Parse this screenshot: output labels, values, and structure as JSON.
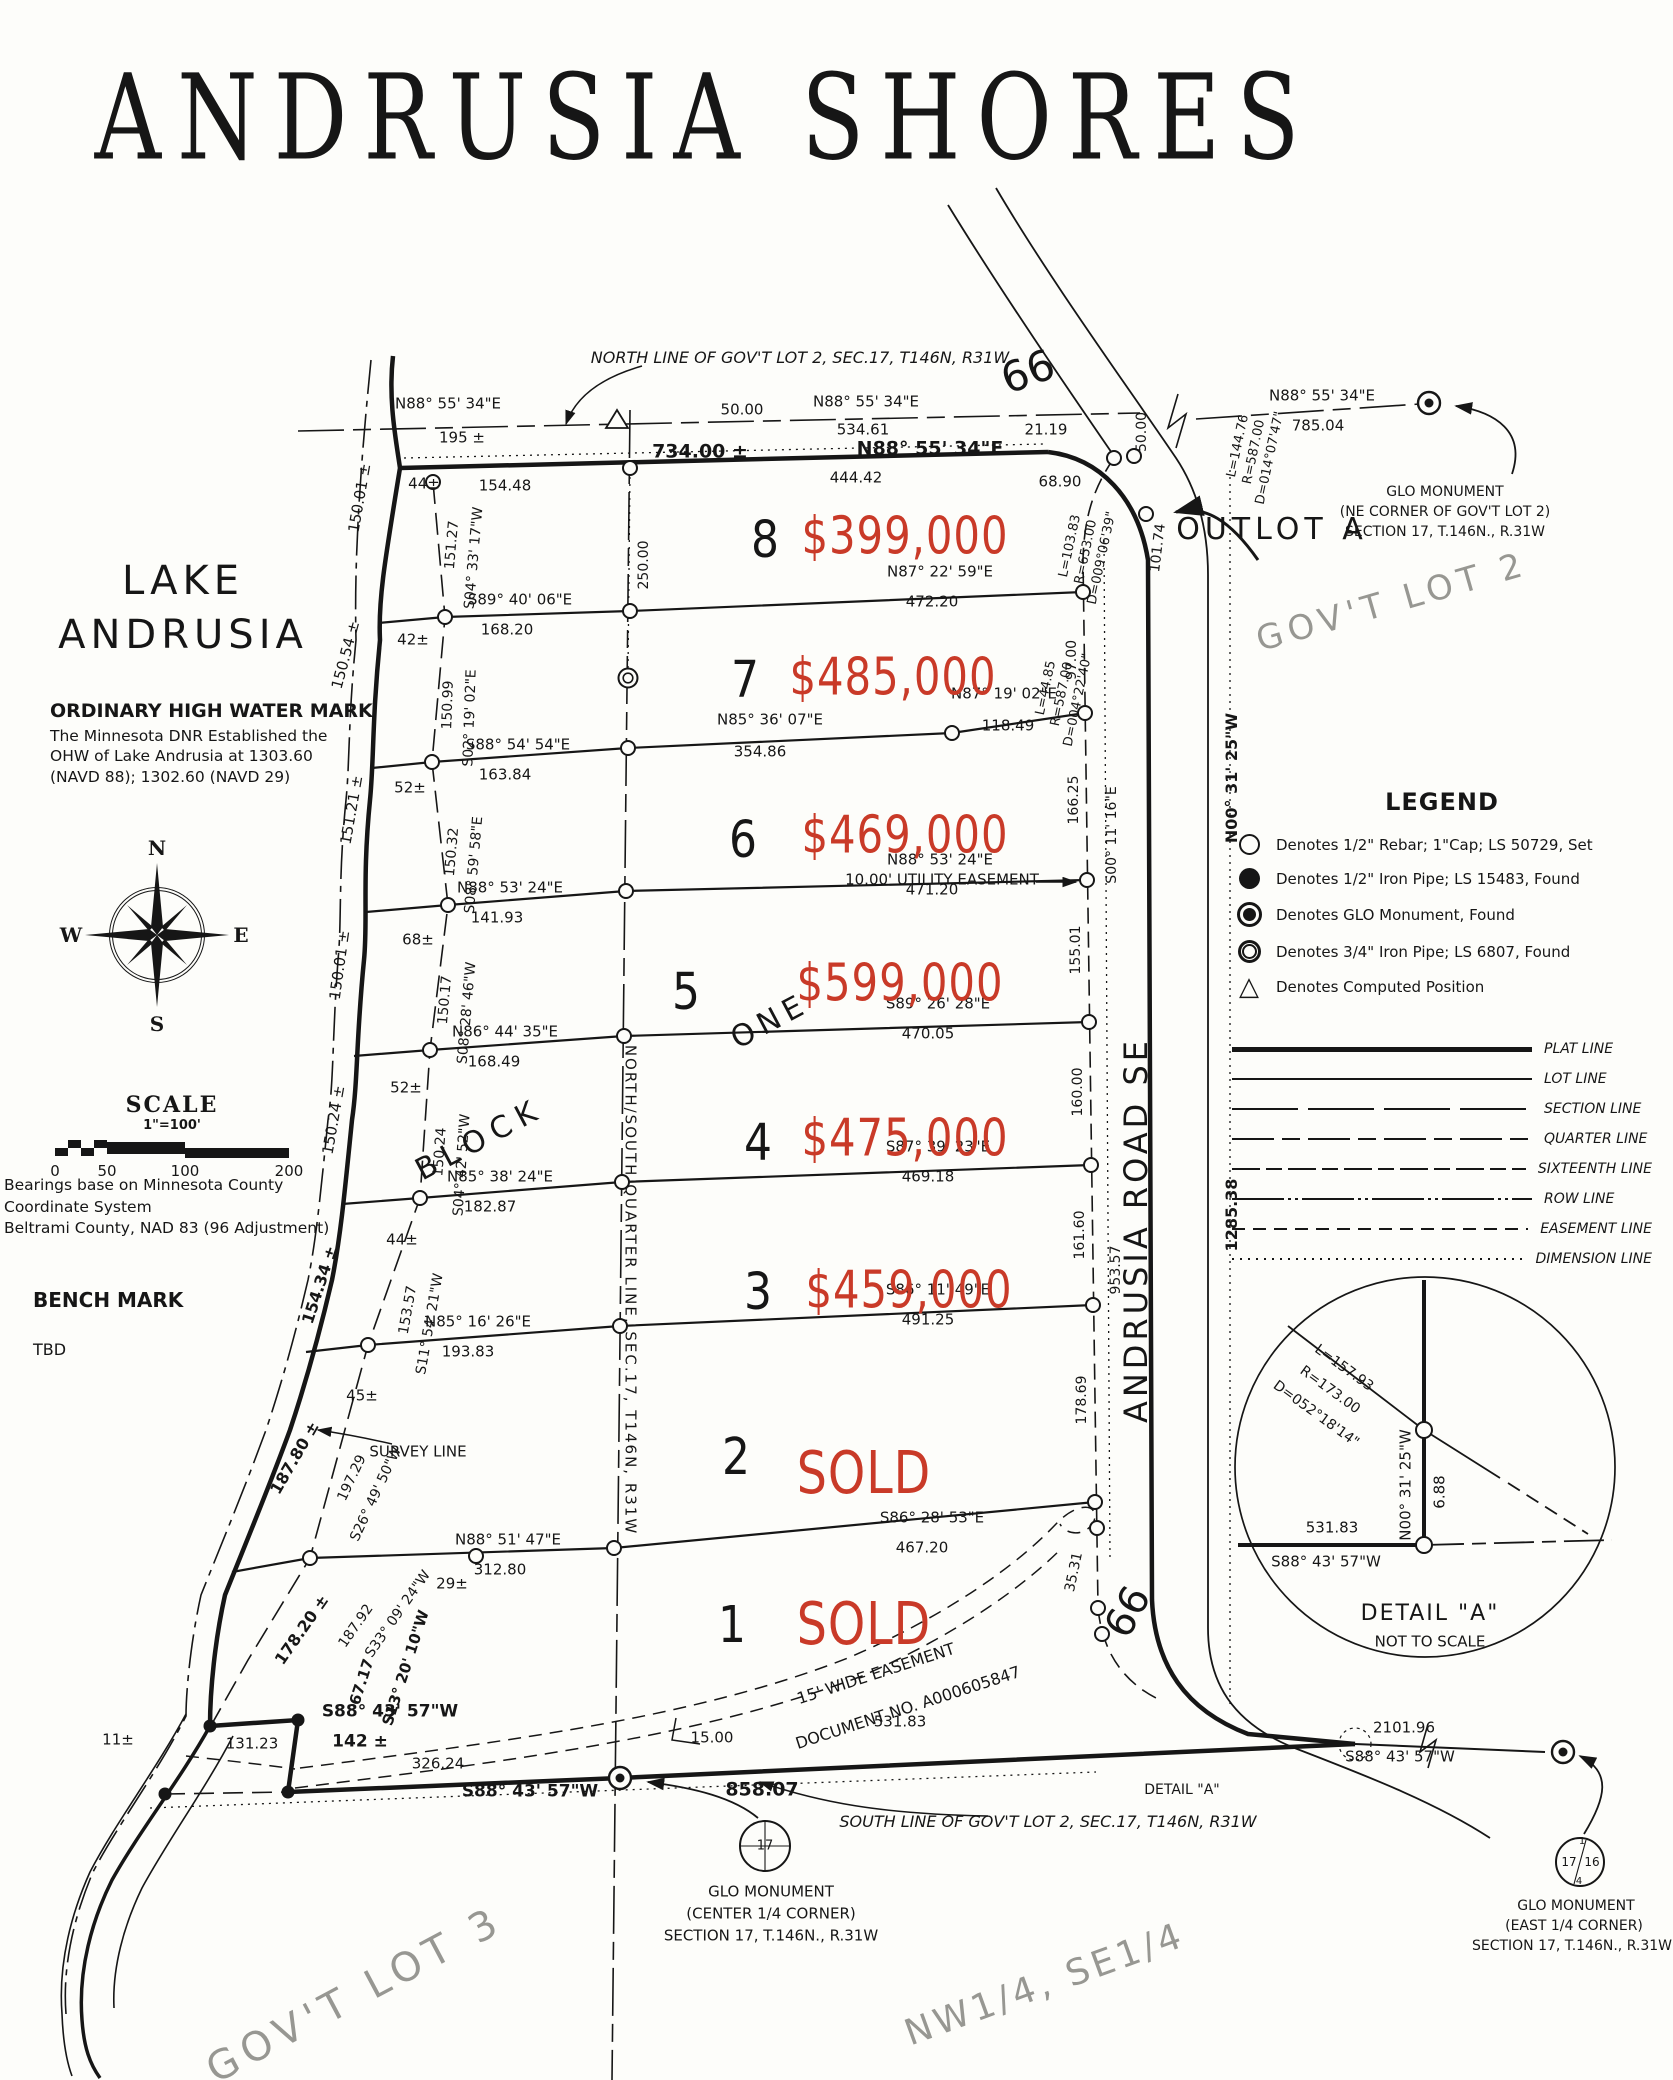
{
  "title": "ANDRUSIA SHORES",
  "colors": {
    "ink": "#161616",
    "red": "#c93a28",
    "ghost": "#979792"
  },
  "lake": {
    "line1": "LAKE",
    "line2": "ANDRUSIA"
  },
  "ohw": {
    "heading": "ORDINARY HIGH WATER MARK",
    "lines": [
      "The Minnesota DNR Established the",
      "OHW of Lake Andrusia at 1303.60",
      "(NAVD 88); 1302.60 (NAVD 29)"
    ]
  },
  "compass": {
    "n": "N",
    "e": "E",
    "s": "S",
    "w": "W"
  },
  "scale": {
    "heading": "SCALE",
    "ratio": "1\"=100'",
    "ticks": [
      "0",
      "50",
      "100",
      "200"
    ]
  },
  "bearings_note": [
    "Bearings base on Minnesota County Coordinate System",
    "Beltrami County, NAD 83 (96 Adjustment)"
  ],
  "benchmark": {
    "heading": "BENCH MARK",
    "value": "TBD"
  },
  "legend": {
    "heading": "LEGEND",
    "symbols": [
      {
        "icon": "rebar",
        "text": "Denotes 1/2\" Rebar; 1\"Cap; LS 50729, Set"
      },
      {
        "icon": "pipe",
        "text": "Denotes 1/2\" Iron Pipe; LS 15483, Found"
      },
      {
        "icon": "glo",
        "text": "Denotes GLO Monument, Found"
      },
      {
        "icon": "pipe34",
        "text": "Denotes 3/4\" Iron Pipe; LS 6807, Found"
      },
      {
        "icon": "tri",
        "text": "Denotes Computed Position"
      }
    ],
    "lines": [
      {
        "style": "plat",
        "label": "PLAT LINE"
      },
      {
        "style": "lot",
        "label": "LOT LINE"
      },
      {
        "style": "section",
        "label": "SECTION LINE"
      },
      {
        "style": "quarter",
        "label": "QUARTER LINE"
      },
      {
        "style": "sixteenth",
        "label": "SIXTEENTH LINE"
      },
      {
        "style": "row",
        "label": "ROW LINE"
      },
      {
        "style": "easement",
        "label": "EASEMENT LINE"
      },
      {
        "style": "dimension",
        "label": "DIMENSION LINE"
      }
    ]
  },
  "lots": [
    {
      "number": "8",
      "price": "$399,000",
      "nx": 765,
      "ny": 541,
      "px": 905,
      "py": 537
    },
    {
      "number": "7",
      "price": "$485,000",
      "nx": 745,
      "ny": 681,
      "px": 893,
      "py": 678
    },
    {
      "number": "6",
      "price": "$469,000",
      "nx": 743,
      "ny": 841,
      "px": 905,
      "py": 836
    },
    {
      "number": "5",
      "price": "$599,000",
      "nx": 686,
      "ny": 993,
      "px": 900,
      "py": 984
    },
    {
      "number": "4",
      "price": "$475,000",
      "nx": 758,
      "ny": 1144,
      "px": 905,
      "py": 1139
    },
    {
      "number": "3",
      "price": "$459,000",
      "nx": 758,
      "ny": 1293,
      "px": 909,
      "py": 1291
    },
    {
      "number": "2",
      "price": "SOLD",
      "nx": 736,
      "ny": 1458,
      "px": 864,
      "py": 1473
    },
    {
      "number": "1",
      "price": "SOLD",
      "nx": 732,
      "ny": 1626,
      "px": 864,
      "py": 1624
    }
  ],
  "map_labels": [
    {
      "t": "NORTH LINE OF GOV'T LOT 2, SEC.17, T146N, R31W",
      "x": 800,
      "y": 358,
      "s": 16,
      "i": 1
    },
    {
      "t": "66",
      "x": 1028,
      "y": 372,
      "r": -20,
      "s": 42
    },
    {
      "t": "66",
      "x": 1128,
      "y": 1612,
      "r": -62,
      "s": 40
    },
    {
      "t": "N88° 55' 34\"E",
      "x": 448,
      "y": 404
    },
    {
      "t": "195 ±",
      "x": 462,
      "y": 438
    },
    {
      "t": "50.00",
      "x": 742,
      "y": 410
    },
    {
      "t": "N88° 55' 34\"E",
      "x": 866,
      "y": 402
    },
    {
      "t": "534.61",
      "x": 863,
      "y": 430
    },
    {
      "t": "21.19",
      "x": 1046,
      "y": 430
    },
    {
      "t": "N88° 55' 34\"E",
      "x": 1322,
      "y": 396
    },
    {
      "t": "785.04",
      "x": 1318,
      "y": 426
    },
    {
      "t": "734.00 ±",
      "x": 700,
      "y": 452,
      "s": 19,
      "b": 1
    },
    {
      "t": "N88° 55' 34\"E",
      "x": 930,
      "y": 449,
      "s": 19,
      "b": 1
    },
    {
      "t": "154.48",
      "x": 505,
      "y": 486
    },
    {
      "t": "444.42",
      "x": 856,
      "y": 478
    },
    {
      "t": "68.90",
      "x": 1060,
      "y": 482
    },
    {
      "t": "44±",
      "x": 424,
      "y": 484
    },
    {
      "t": "50.00",
      "x": 1142,
      "y": 432,
      "r": -90,
      "s": 14
    },
    {
      "t": "101.74",
      "x": 1158,
      "y": 548,
      "r": -83,
      "s": 14
    },
    {
      "t": "L=103.83",
      "x": 1070,
      "y": 546,
      "r": -78,
      "s": 13
    },
    {
      "t": "R=653.00",
      "x": 1086,
      "y": 552,
      "r": -78,
      "s": 13
    },
    {
      "t": "D=009°06'39\"",
      "x": 1102,
      "y": 558,
      "r": -78,
      "s": 13
    },
    {
      "t": "GLO MONUMENT",
      "x": 1445,
      "y": 492,
      "s": 14
    },
    {
      "t": "(NE CORNER OF GOV'T LOT 2)",
      "x": 1445,
      "y": 512,
      "s": 14
    },
    {
      "t": "SECTION 17, T.146N., R.31W",
      "x": 1445,
      "y": 532,
      "s": 14
    },
    {
      "t": "OUTLOT A",
      "x": 1272,
      "y": 530,
      "s": 30,
      "ls": 5
    },
    {
      "t": "GOV'T LOT 2",
      "x": 1392,
      "y": 602,
      "r": -16,
      "s": 34,
      "g": 1,
      "ls": 6
    },
    {
      "t": "L=144.76",
      "x": 1238,
      "y": 446,
      "r": -78,
      "s": 13
    },
    {
      "t": "R=587.00",
      "x": 1254,
      "y": 452,
      "r": -78,
      "s": 13
    },
    {
      "t": "D=014°07'47\"",
      "x": 1270,
      "y": 458,
      "r": -78,
      "s": 13
    },
    {
      "t": "150.01 ±",
      "x": 360,
      "y": 498,
      "r": -80,
      "s": 15
    },
    {
      "t": "151.27",
      "x": 452,
      "y": 545,
      "r": -85,
      "s": 14
    },
    {
      "t": "S04° 33' 17\"W",
      "x": 474,
      "y": 558,
      "r": -85,
      "s": 14
    },
    {
      "t": "S89° 40' 06\"E",
      "x": 520,
      "y": 600
    },
    {
      "t": "168.20",
      "x": 507,
      "y": 630
    },
    {
      "t": "N87° 22' 59\"E",
      "x": 940,
      "y": 572
    },
    {
      "t": "472.20",
      "x": 932,
      "y": 602
    },
    {
      "t": "42±",
      "x": 413,
      "y": 640
    },
    {
      "t": "250.00",
      "x": 644,
      "y": 565,
      "r": -90,
      "s": 14
    },
    {
      "t": "150.54 ±",
      "x": 346,
      "y": 655,
      "r": -75,
      "s": 15
    },
    {
      "t": "150.99",
      "x": 448,
      "y": 705,
      "r": -88,
      "s": 14
    },
    {
      "t": "S02° 19' 02\"E",
      "x": 470,
      "y": 718,
      "r": -88,
      "s": 14
    },
    {
      "t": "L=44.85",
      "x": 1046,
      "y": 688,
      "r": -78,
      "s": 13
    },
    {
      "t": "R=587.00",
      "x": 1062,
      "y": 694,
      "r": -78,
      "s": 13
    },
    {
      "t": "D=004°22'40\"",
      "x": 1078,
      "y": 700,
      "r": -78,
      "s": 13
    },
    {
      "t": "97.00",
      "x": 1072,
      "y": 660,
      "r": -90,
      "s": 14
    },
    {
      "t": "S88° 54' 54\"E",
      "x": 518,
      "y": 745
    },
    {
      "t": "163.84",
      "x": 505,
      "y": 775
    },
    {
      "t": "N85° 36' 07\"E",
      "x": 770,
      "y": 720
    },
    {
      "t": "354.86",
      "x": 760,
      "y": 752
    },
    {
      "t": "N87° 19' 02\"E",
      "x": 1004,
      "y": 694
    },
    {
      "t": "118.49",
      "x": 1008,
      "y": 726
    },
    {
      "t": "52±",
      "x": 410,
      "y": 788
    },
    {
      "t": "151.21 ±",
      "x": 352,
      "y": 810,
      "r": -80,
      "s": 15
    },
    {
      "t": "150.32",
      "x": 452,
      "y": 852,
      "r": -85,
      "s": 14
    },
    {
      "t": "S08° 59' 58\"E",
      "x": 474,
      "y": 865,
      "r": -85,
      "s": 14
    },
    {
      "t": "10.00' UTILITY EASEMENT",
      "x": 942,
      "y": 880,
      "s": 15
    },
    {
      "t": "166.25",
      "x": 1074,
      "y": 800,
      "r": -90,
      "s": 14
    },
    {
      "t": "N88° 53' 24\"E",
      "x": 510,
      "y": 888
    },
    {
      "t": "141.93",
      "x": 497,
      "y": 918
    },
    {
      "t": "N88° 53' 24\"E",
      "x": 940,
      "y": 860
    },
    {
      "t": "471.20",
      "x": 932,
      "y": 890
    },
    {
      "t": "68±",
      "x": 418,
      "y": 940
    },
    {
      "t": "150.01 ±",
      "x": 340,
      "y": 965,
      "r": -82,
      "s": 15
    },
    {
      "t": "150.17",
      "x": 445,
      "y": 1000,
      "r": -85,
      "s": 14
    },
    {
      "t": "S08° 28' 46\"W",
      "x": 467,
      "y": 1013,
      "r": -85,
      "s": 14
    },
    {
      "t": "155.01",
      "x": 1076,
      "y": 950,
      "r": -90,
      "s": 14
    },
    {
      "t": "S00° 11' 16\"E",
      "x": 1112,
      "y": 835,
      "r": -90,
      "s": 14
    },
    {
      "t": "ONE",
      "x": 770,
      "y": 1022,
      "r": -28,
      "s": 30,
      "ls": 6
    },
    {
      "t": "N86° 44' 35\"E",
      "x": 505,
      "y": 1032
    },
    {
      "t": "168.49",
      "x": 494,
      "y": 1062
    },
    {
      "t": "S89° 26' 28\"E",
      "x": 938,
      "y": 1004
    },
    {
      "t": "470.05",
      "x": 928,
      "y": 1034
    },
    {
      "t": "52±",
      "x": 406,
      "y": 1088
    },
    {
      "t": "150.24 ±",
      "x": 334,
      "y": 1120,
      "r": -80,
      "s": 15
    },
    {
      "t": "150.24",
      "x": 440,
      "y": 1152,
      "r": -86,
      "s": 14
    },
    {
      "t": "S04° 42' 52\"W",
      "x": 462,
      "y": 1165,
      "r": -86,
      "s": 14
    },
    {
      "t": "BLOCK",
      "x": 480,
      "y": 1140,
      "r": -28,
      "s": 30,
      "ls": 8
    },
    {
      "t": "160.00",
      "x": 1078,
      "y": 1092,
      "r": -90,
      "s": 14
    },
    {
      "t": "NORTH/SOUTH QUARTER LINE,  SEC.17, T146N, R31W",
      "x": 630,
      "y": 1290,
      "r": 90,
      "s": 15,
      "ls": 2
    },
    {
      "t": "N85° 38' 24\"E",
      "x": 500,
      "y": 1177
    },
    {
      "t": "182.87",
      "x": 490,
      "y": 1207
    },
    {
      "t": "S87° 39' 23\"E",
      "x": 938,
      "y": 1147
    },
    {
      "t": "469.18",
      "x": 928,
      "y": 1177
    },
    {
      "t": "44±",
      "x": 402,
      "y": 1240
    },
    {
      "t": "154.34 ±",
      "x": 320,
      "y": 1285,
      "r": -72,
      "s": 16,
      "b": 1
    },
    {
      "t": "153.57",
      "x": 408,
      "y": 1310,
      "r": -80,
      "s": 14
    },
    {
      "t": "S11° 54' 21\"W",
      "x": 430,
      "y": 1324,
      "r": -80,
      "s": 14
    },
    {
      "t": "161.60",
      "x": 1080,
      "y": 1235,
      "r": -90,
      "s": 14
    },
    {
      "t": "953.57",
      "x": 1116,
      "y": 1270,
      "r": -90,
      "s": 14
    },
    {
      "t": "ANDRUSIA ROAD SE",
      "x": 1136,
      "y": 1230,
      "r": -90,
      "s": 32,
      "ls": 4
    },
    {
      "t": "N00° 31' 25\"W",
      "x": 1232,
      "y": 778,
      "r": -90,
      "s": 16,
      "b": 1
    },
    {
      "t": "1285.38",
      "x": 1232,
      "y": 1215,
      "r": -90,
      "s": 16,
      "b": 1
    },
    {
      "t": "N85° 16' 26\"E",
      "x": 478,
      "y": 1322
    },
    {
      "t": "193.83",
      "x": 468,
      "y": 1352
    },
    {
      "t": "S86° 11' 49\"E",
      "x": 938,
      "y": 1290
    },
    {
      "t": "491.25",
      "x": 928,
      "y": 1320
    },
    {
      "t": "45±",
      "x": 362,
      "y": 1396
    },
    {
      "t": "SURVEY LINE",
      "x": 418,
      "y": 1452,
      "s": 15
    },
    {
      "t": "187.80 ±",
      "x": 295,
      "y": 1458,
      "r": -60,
      "s": 16,
      "b": 1
    },
    {
      "t": "197.29",
      "x": 352,
      "y": 1478,
      "r": -65,
      "s": 14
    },
    {
      "t": "S26° 49' 50\"W",
      "x": 376,
      "y": 1494,
      "r": -65,
      "s": 14
    },
    {
      "t": "178.69",
      "x": 1082,
      "y": 1400,
      "r": -90,
      "s": 14
    },
    {
      "t": "N88° 51' 47\"E",
      "x": 508,
      "y": 1540
    },
    {
      "t": "312.80",
      "x": 500,
      "y": 1570
    },
    {
      "t": "S86° 28' 53\"E",
      "x": 932,
      "y": 1518
    },
    {
      "t": "467.20",
      "x": 922,
      "y": 1548
    },
    {
      "t": "29±",
      "x": 452,
      "y": 1584
    },
    {
      "t": "35.31",
      "x": 1074,
      "y": 1572,
      "r": -78,
      "s": 14
    },
    {
      "t": "178.20 ±",
      "x": 302,
      "y": 1630,
      "r": -55,
      "s": 16,
      "b": 1
    },
    {
      "t": "187.92",
      "x": 356,
      "y": 1626,
      "r": -55,
      "s": 14
    },
    {
      "t": "S33° 09' 24\"W",
      "x": 398,
      "y": 1614,
      "r": -55,
      "s": 14
    },
    {
      "t": "S88° 43' 57\"W",
      "x": 390,
      "y": 1712,
      "s": 17,
      "b": 1
    },
    {
      "t": "142 ±",
      "x": 360,
      "y": 1742,
      "s": 17,
      "b": 1
    },
    {
      "t": "67.17",
      "x": 362,
      "y": 1682,
      "r": -72,
      "s": 15,
      "b": 1
    },
    {
      "t": "S13° 20' 10\"W",
      "x": 406,
      "y": 1668,
      "r": -72,
      "s": 15,
      "b": 1
    },
    {
      "t": "131.23",
      "x": 252,
      "y": 1744
    },
    {
      "t": "11±",
      "x": 118,
      "y": 1740
    },
    {
      "t": "326.24",
      "x": 438,
      "y": 1764
    },
    {
      "t": "S88° 43' 57\"W",
      "x": 530,
      "y": 1792,
      "s": 17,
      "b": 1
    },
    {
      "t": "858.07",
      "x": 762,
      "y": 1790,
      "s": 19,
      "b": 1
    },
    {
      "t": "531.83",
      "x": 900,
      "y": 1722
    },
    {
      "t": "15.00",
      "x": 712,
      "y": 1738
    },
    {
      "t": "15' WIDE EASEMENT",
      "x": 876,
      "y": 1674,
      "r": -18,
      "s": 16
    },
    {
      "t": "DOCUMENT NO. A000605847",
      "x": 908,
      "y": 1708,
      "r": -18,
      "s": 16
    },
    {
      "t": "SOUTH LINE OF GOV'T LOT 2, SEC.17, T146N, R31W",
      "x": 1048,
      "y": 1822,
      "s": 16,
      "i": 1
    },
    {
      "t": "DETAIL \"A\"",
      "x": 1182,
      "y": 1790,
      "s": 14
    },
    {
      "t": "17",
      "x": 765,
      "y": 1846,
      "s": 13
    },
    {
      "t": "GLO MONUMENT",
      "x": 771,
      "y": 1892,
      "s": 15
    },
    {
      "t": "(CENTER 1/4 CORNER)",
      "x": 771,
      "y": 1914,
      "s": 15
    },
    {
      "t": "SECTION 17, T.146N., R.31W",
      "x": 771,
      "y": 1936,
      "s": 15
    },
    {
      "t": "2101.96",
      "x": 1404,
      "y": 1728
    },
    {
      "t": "S88° 43' 57\"W",
      "x": 1400,
      "y": 1757
    },
    {
      "t": "17",
      "x": 1569,
      "y": 1862,
      "s": 12
    },
    {
      "t": "16",
      "x": 1592,
      "y": 1862,
      "s": 12
    },
    {
      "t": "1",
      "x": 1582,
      "y": 1842,
      "s": 10
    },
    {
      "t": "4",
      "x": 1579,
      "y": 1882,
      "s": 10
    },
    {
      "t": "GLO MONUMENT",
      "x": 1576,
      "y": 1906,
      "s": 14
    },
    {
      "t": "(EAST 1/4 CORNER)",
      "x": 1574,
      "y": 1926,
      "s": 14
    },
    {
      "t": "SECTION 17, T.146N., R.31W",
      "x": 1572,
      "y": 1946,
      "s": 14
    },
    {
      "t": "L=157.93",
      "x": 1344,
      "y": 1368,
      "r": 36,
      "s": 14
    },
    {
      "t": "R=173.00",
      "x": 1330,
      "y": 1390,
      "r": 36,
      "s": 14
    },
    {
      "t": "D=052°18'14\"",
      "x": 1316,
      "y": 1414,
      "r": 36,
      "s": 14
    },
    {
      "t": "N00° 31' 25\"W",
      "x": 1406,
      "y": 1485,
      "r": -90,
      "s": 15
    },
    {
      "t": "6.88",
      "x": 1440,
      "y": 1492,
      "r": -90,
      "s": 15
    },
    {
      "t": "531.83",
      "x": 1332,
      "y": 1528
    },
    {
      "t": "S88° 43' 57\"W",
      "x": 1326,
      "y": 1562
    },
    {
      "t": "DETAIL  \"A\"",
      "x": 1430,
      "y": 1614,
      "s": 22,
      "ls": 2
    },
    {
      "t": "NOT TO SCALE",
      "x": 1430,
      "y": 1642,
      "s": 15
    },
    {
      "t": "GOV'T LOT 3",
      "x": 355,
      "y": 1995,
      "r": -28,
      "s": 40,
      "g": 1,
      "ls": 7
    },
    {
      "t": "NW1/4,  SE1/4",
      "x": 1045,
      "y": 1985,
      "r": -20,
      "s": 36,
      "g": 1,
      "ls": 4
    }
  ]
}
